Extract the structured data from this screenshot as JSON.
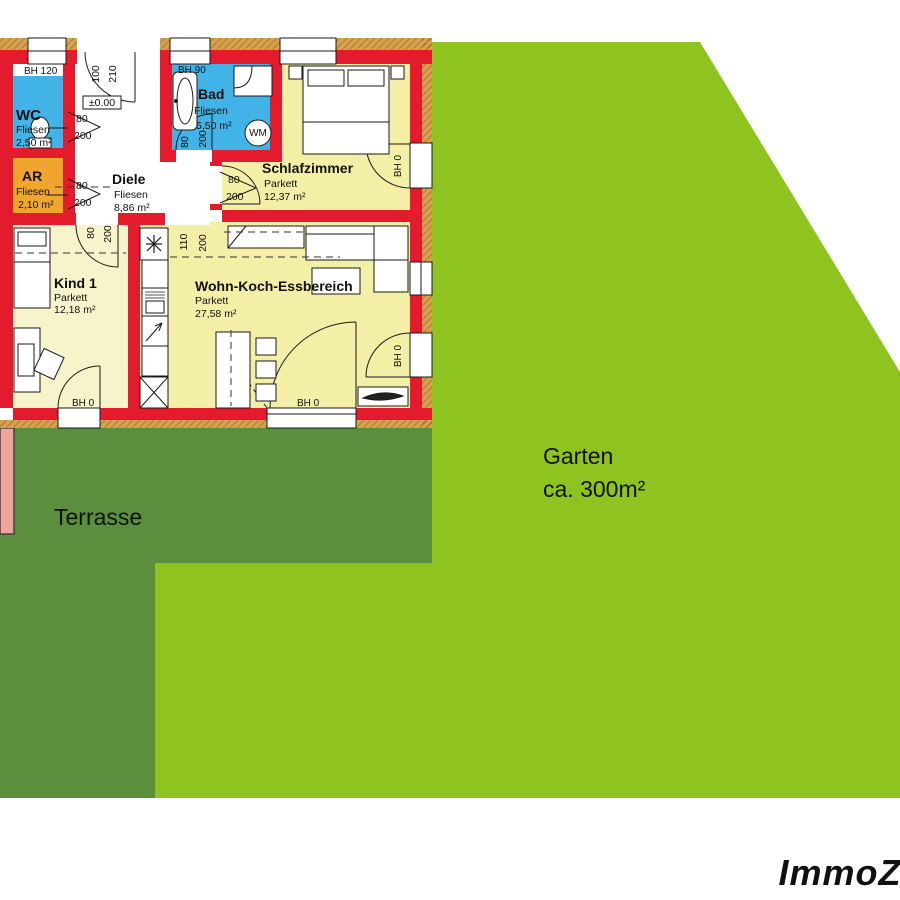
{
  "colors": {
    "garden": "#8FC31F",
    "terrace": "#5C8F3D",
    "wall": "#E41B2D",
    "tile_blue": "#41B3E6",
    "storage_orange": "#F0A52F",
    "bedroom_floor": "#F3EFA6",
    "kids_floor": "#F7F3CB",
    "living_floor": "#F3EFA6",
    "insulation_tan": "#D7A14E",
    "neighbor_pink": "#F0A59D",
    "watermark_gray": "#E8E8E8"
  },
  "rooms": [
    {
      "name": "WC",
      "floor": "Fliesen",
      "area": "2,50 m²"
    },
    {
      "name": "AR",
      "floor": "Fliesen",
      "area": "2,10 m²"
    },
    {
      "name": "Diele",
      "floor": "Fliesen",
      "area": "8,86 m²"
    },
    {
      "name": "Bad",
      "floor": "Fliesen",
      "area": "5,50 m²"
    },
    {
      "name": "Schlafzimmer",
      "floor": "Parkett",
      "area": "12,37 m²"
    },
    {
      "name": "Kind 1",
      "floor": "Parkett",
      "area": "12,18 m²"
    },
    {
      "name": "Wohn-Koch-Essbereich",
      "floor": "Parkett",
      "area": "27,58 m²"
    }
  ],
  "dims": {
    "w80": "80",
    "h200": "200",
    "w100": "100",
    "h210": "210",
    "w110": "110",
    "level": "±0.00"
  },
  "bh": {
    "b120": "BH 120",
    "b90": "BH 90",
    "b0": "BH 0"
  },
  "appliance": {
    "wm": "WM"
  },
  "outdoor": {
    "garden_title": "Garten",
    "garden_size": "ca. 300m²",
    "terrace": "Terrasse"
  },
  "watermark": {
    "brand": "ImmoZ"
  }
}
